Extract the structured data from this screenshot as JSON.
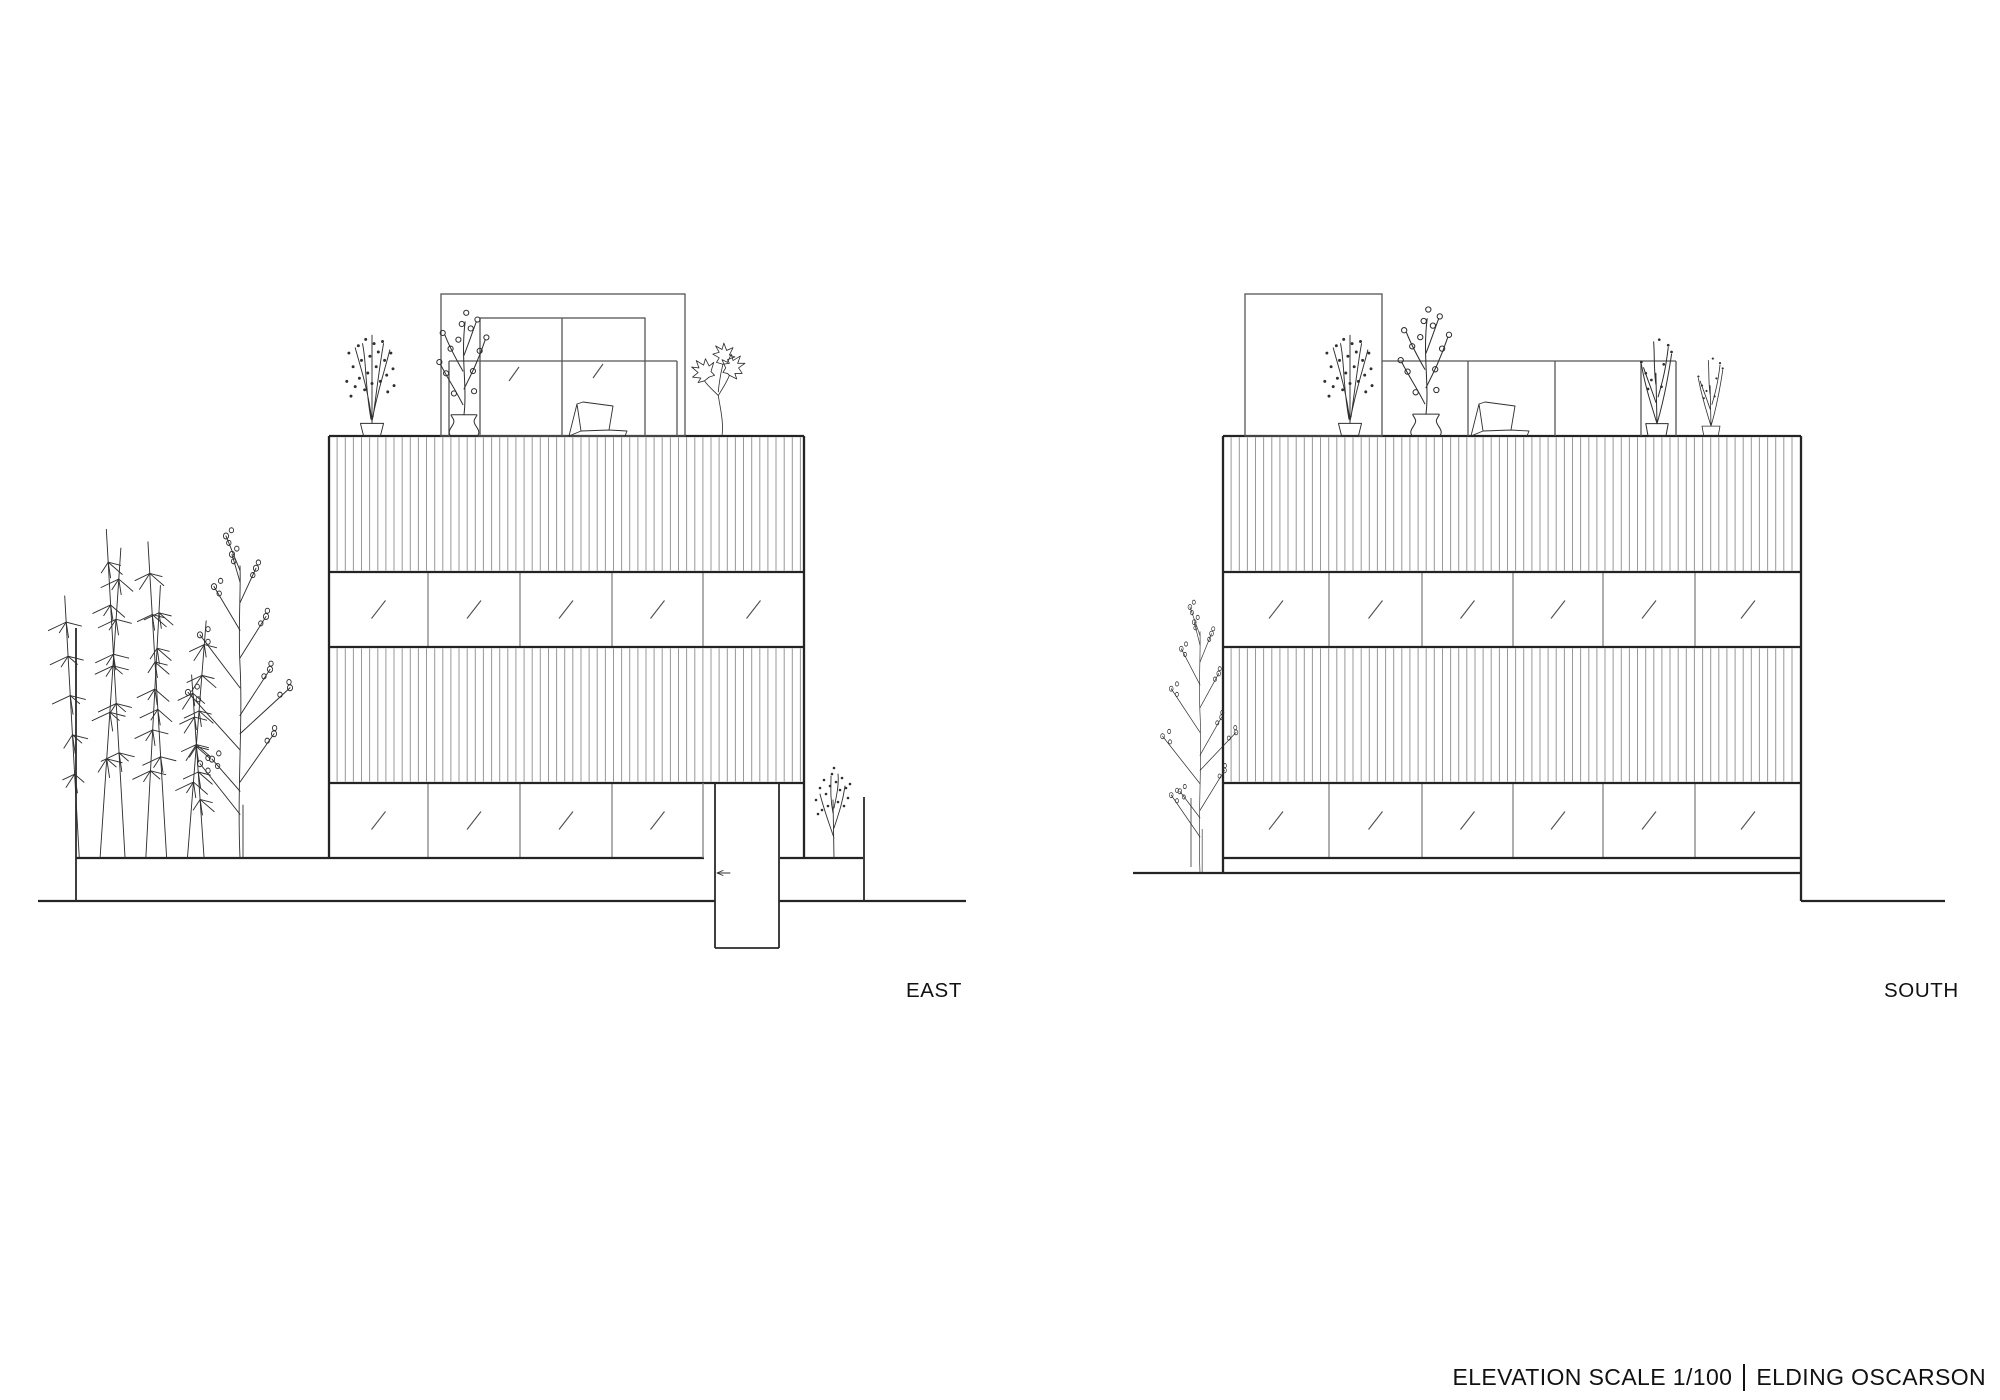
{
  "labels": {
    "east": "EAST",
    "south": "SOUTH"
  },
  "title_block": {
    "scale_text": "ELEVATION SCALE 1/100",
    "separator": "|",
    "firm_text": "ELDING OSCARSON"
  },
  "drawing": {
    "canvas": {
      "w": 2000,
      "h": 1400
    },
    "colors": {
      "heavy": "#242424",
      "medium": "#555555",
      "mullion": "#7d7d7d",
      "slat": "#989898",
      "sketch": "#2f2f2f",
      "background": "#ffffff"
    },
    "levels": {
      "roof_top": 436,
      "band1_bottom": 572,
      "band2_bottom": 647,
      "band3_bottom": 783,
      "base": 858
    },
    "slat_spacing": 8.128,
    "elevations": {
      "east": {
        "left": 329,
        "right": 804,
        "left_bottom": 858,
        "right_bottom": 858,
        "mullions_upper": [
          428,
          520,
          612,
          703
        ],
        "mullions_lower": [
          428,
          520,
          612
        ],
        "lower_ticks_right": 703,
        "base_segments": [
          [
            76,
            704
          ],
          [
            780,
            863
          ]
        ],
        "ground_lines": [
          {
            "y": 901,
            "x1": 38,
            "x2": 715
          },
          {
            "y": 901,
            "x1": 779,
            "x2": 966
          }
        ],
        "wall_lines": [
          [
            76,
            628,
            76,
            901
          ],
          [
            864,
            797,
            864,
            901
          ],
          [
            715,
            783,
            715,
            948
          ],
          [
            779,
            783,
            779,
            948
          ],
          [
            715,
            948,
            779,
            948
          ]
        ],
        "thin_lines": [
          [
            703,
            783,
            703,
            858
          ]
        ],
        "arrow": {
          "x": 717,
          "y": 873
        },
        "penthouse": {
          "x1": 441,
          "x2": 685,
          "top": 294
        },
        "rail": {
          "x1": 449,
          "x2": 677,
          "y": 361,
          "posts": [
            449,
            677
          ]
        },
        "roof_window": {
          "x1": 480,
          "x2": 645,
          "top": 318,
          "mullions": [
            562
          ],
          "ticks": [
            [
              514,
              374
            ],
            [
              598,
              371
            ]
          ]
        },
        "label": {
          "x": 906,
          "y": 997
        },
        "plants": [
          {
            "type": "dotsPlant",
            "name": "potted-plant",
            "x": 372,
            "y": 436,
            "s": 1.05
          },
          {
            "type": "vaseBranch",
            "name": "vase-plant",
            "x": 464,
            "y": 436,
            "s": 1.12
          },
          {
            "type": "chair",
            "name": "lounge-chair",
            "x": 600,
            "y": 436,
            "s": 1
          },
          {
            "type": "bigLeaf",
            "name": "leafy-plant",
            "x": 722,
            "y": 436,
            "s": 0.92
          },
          {
            "type": "bamboo",
            "name": "bamboo-tree",
            "x": 150,
            "y": 858,
            "s": 1.04
          },
          {
            "type": "roundTree",
            "name": "round-leaf-tree",
            "x": 240,
            "y": 858,
            "s": 1.15,
            "sx": 1
          },
          {
            "type": "dotsTree",
            "name": "planter-tree",
            "x": 834,
            "y": 858,
            "s": 1
          }
        ]
      },
      "south": {
        "left": 1223,
        "right": 1801,
        "left_bottom": 873,
        "right_bottom": 901,
        "mullions_upper": [
          1329,
          1422,
          1513,
          1603,
          1695
        ],
        "mullions_lower": [
          1329,
          1422,
          1513,
          1603,
          1695
        ],
        "base_segments": [
          [
            1223,
            1801
          ]
        ],
        "ground_lines": [
          {
            "y": 873,
            "x1": 1133,
            "x2": 1801
          },
          {
            "y": 901,
            "x1": 1801,
            "x2": 1945
          }
        ],
        "wall_lines": [],
        "thin_lines": [
          [
            1191,
            798,
            1191,
            867
          ]
        ],
        "penthouse": {
          "x1": 1245,
          "x2": 1382,
          "top": 294
        },
        "rail": {
          "x1": 1382,
          "x2": 1676,
          "y": 361,
          "posts": [
            1468,
            1555,
            1641,
            1676
          ]
        },
        "label": {
          "x": 1884,
          "y": 997
        },
        "plants": [
          {
            "type": "dotsPlant",
            "name": "potted-plant",
            "x": 1350,
            "y": 436,
            "s": 1.05
          },
          {
            "type": "vaseBranch",
            "name": "vase-plant",
            "x": 1426,
            "y": 436,
            "s": 1.15
          },
          {
            "type": "chair",
            "name": "lounge-chair",
            "x": 1502,
            "y": 436,
            "s": 1
          },
          {
            "type": "wispy",
            "name": "wispy-plant",
            "x": 1657,
            "y": 436,
            "s": 1.12
          },
          {
            "type": "wispy",
            "name": "wispy-plant",
            "x": 1711,
            "y": 436,
            "s": 0.9
          },
          {
            "type": "roundTree",
            "name": "street-tree",
            "x": 1200,
            "y": 873,
            "s": 0.95,
            "sx": 0.72
          }
        ]
      }
    }
  }
}
